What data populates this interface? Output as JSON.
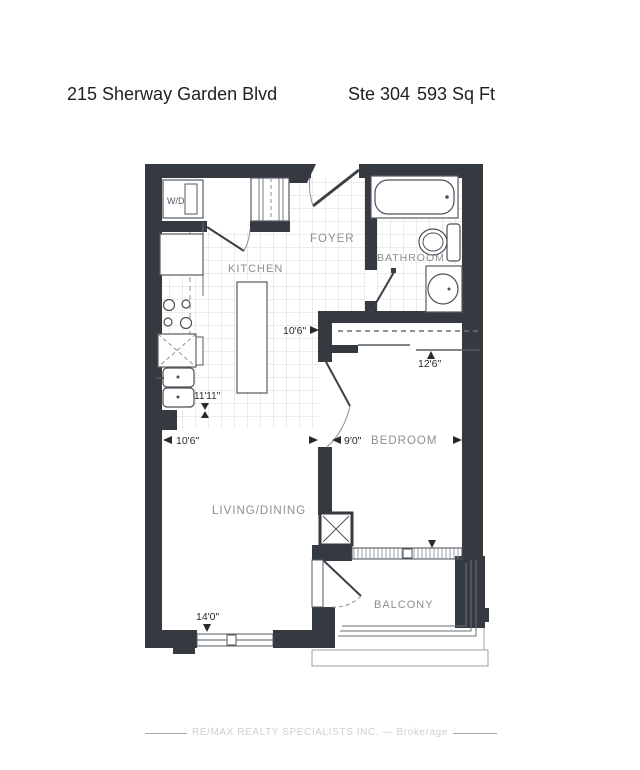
{
  "header": {
    "address": "215 Sherway Garden Blvd",
    "suite": "Ste 304",
    "area": "593 Sq Ft"
  },
  "rooms": {
    "laundry": "W/D",
    "foyer": "FOYER",
    "kitchen": "KITCHEN",
    "bathroom": "BATHROOM",
    "bedroom": "BEDROOM",
    "living_dining": "LIVING/DINING",
    "balcony": "BALCONY"
  },
  "dimensions": {
    "foyer_width": "10'6\"",
    "bedroom_length": "12'6\"",
    "kitchen_length": "11'11\"",
    "living_width": "10'6\"",
    "bedroom_width": "9'0\"",
    "living_length": "14'0\""
  },
  "footer": {
    "brokerage": "RE/MAX REALTY SPECIALISTS INC. — Brokerage"
  },
  "colors": {
    "wall": "#343a40",
    "tile_line": "#d9d9d9",
    "fixture_line": "#4a5056",
    "room_label": "#8a8f94",
    "dimension_text": "#2a2a2a"
  }
}
